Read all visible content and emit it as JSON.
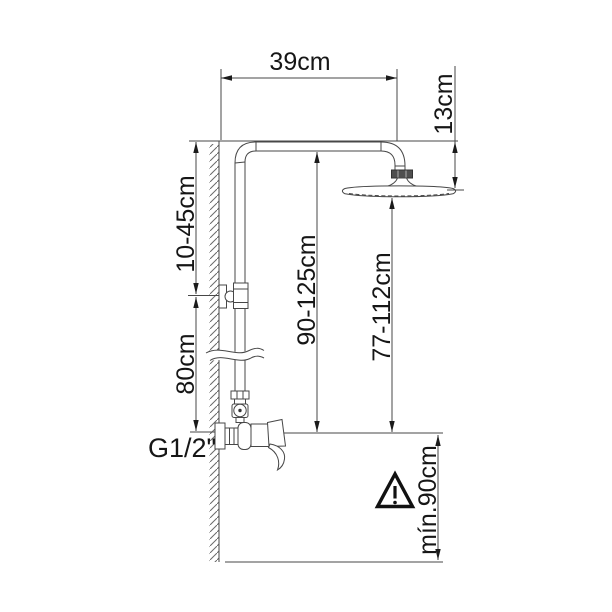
{
  "diagram": {
    "type": "technical-installation-drawing",
    "subject": "shower column with overhead rain shower head and wall-mounted mixer valve",
    "background": "#ffffff",
    "line_color": "#474747",
    "text_color": "#161616",
    "labels": {
      "arm_reach": "39cm",
      "head_offset": "13cm",
      "upper_adjust": "10-45cm",
      "inlet_height": "80cm",
      "column_range": "90-125cm",
      "head_range": "77-112cm",
      "thread_size": "G1/2\"",
      "min_clearance": "mín.90cm"
    },
    "icons": {
      "warning": "warning-triangle-icon"
    }
  }
}
